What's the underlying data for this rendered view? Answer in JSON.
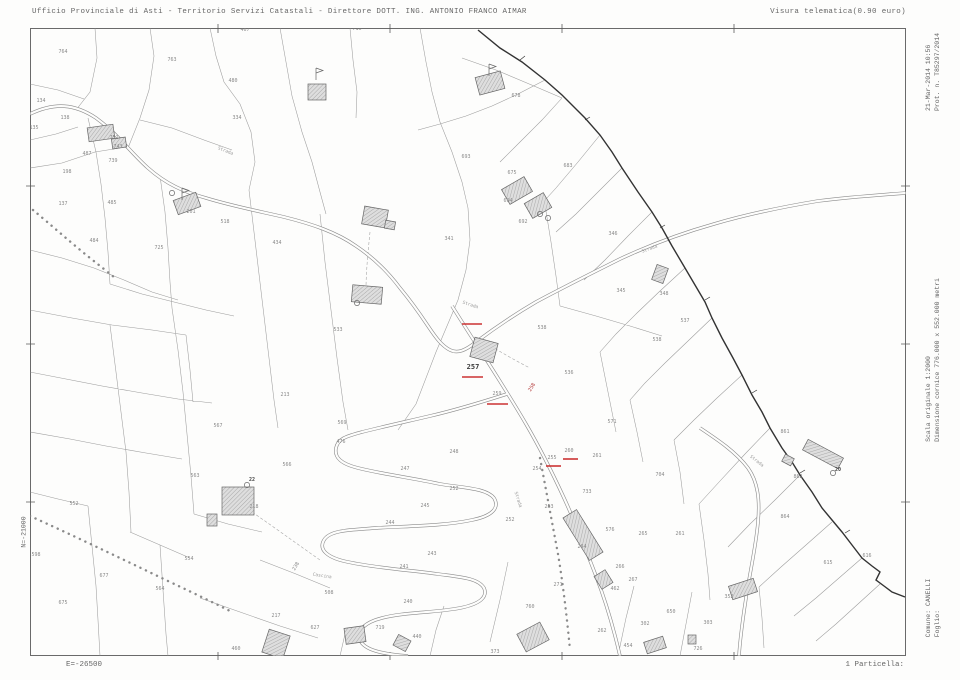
{
  "header": {
    "left": "Ufficio Provinciale di Asti - Territorio Servizi Catastali - Direttore DOTT. ING. ANTONIO FRANCO AIMAR",
    "right": "Visura telematica(0.90 euro)"
  },
  "margins": {
    "datetime": "21-Mar-2014 10:56",
    "protocol": "Prot. n. T85297/2014",
    "scale": "Scala originale 1:2000",
    "frame_size": "Dimensione cornice 776.000 x 552.000 metri",
    "comune": "Comune: CANELLI",
    "foglio": "Foglio:",
    "north_coord": "N=-21000",
    "east_coord": "E=-26500",
    "particella": "1 Particella:"
  },
  "colors": {
    "red": "#c33",
    "line": "#9c9c9c",
    "boundary": "#333333",
    "label": "#8a8a8a"
  },
  "map": {
    "selected_parcel": "257",
    "parcel_labels": [
      {
        "t": "716",
        "x": 357,
        "y": 30
      },
      {
        "t": "467",
        "x": 245,
        "y": 31
      },
      {
        "t": "764",
        "x": 63,
        "y": 53
      },
      {
        "t": "763",
        "x": 172,
        "y": 61
      },
      {
        "t": "480",
        "x": 233,
        "y": 82
      },
      {
        "t": "134",
        "x": 41,
        "y": 102
      },
      {
        "t": "138",
        "x": 65,
        "y": 119
      },
      {
        "t": "135",
        "x": 34,
        "y": 129
      },
      {
        "t": "487",
        "x": 87,
        "y": 155
      },
      {
        "t": "739",
        "x": 113,
        "y": 162
      },
      {
        "t": "198",
        "x": 67,
        "y": 173
      },
      {
        "t": "137",
        "x": 63,
        "y": 205
      },
      {
        "t": "485",
        "x": 112,
        "y": 204
      },
      {
        "t": "484",
        "x": 94,
        "y": 242
      },
      {
        "t": "725",
        "x": 159,
        "y": 249
      },
      {
        "t": "334",
        "x": 237,
        "y": 119
      },
      {
        "t": "201",
        "x": 191,
        "y": 213
      },
      {
        "t": "751",
        "x": 114,
        "y": 139
      },
      {
        "t": "743",
        "x": 118,
        "y": 148
      },
      {
        "t": "518",
        "x": 225,
        "y": 223
      },
      {
        "t": "434",
        "x": 277,
        "y": 244
      },
      {
        "t": "678",
        "x": 516,
        "y": 97
      },
      {
        "t": "693",
        "x": 466,
        "y": 158
      },
      {
        "t": "683",
        "x": 568,
        "y": 167
      },
      {
        "t": "675",
        "x": 512,
        "y": 174
      },
      {
        "t": "694",
        "x": 508,
        "y": 202
      },
      {
        "t": "692",
        "x": 523,
        "y": 223
      },
      {
        "t": "346",
        "x": 613,
        "y": 235
      },
      {
        "t": "341",
        "x": 449,
        "y": 240
      },
      {
        "t": "345",
        "x": 621,
        "y": 292
      },
      {
        "t": "348",
        "x": 664,
        "y": 295
      },
      {
        "t": "537",
        "x": 685,
        "y": 322
      },
      {
        "t": "538",
        "x": 657,
        "y": 341
      },
      {
        "t": "533",
        "x": 338,
        "y": 331
      },
      {
        "t": "213",
        "x": 285,
        "y": 396
      },
      {
        "t": "538",
        "x": 542,
        "y": 329
      },
      {
        "t": "536",
        "x": 569,
        "y": 374
      },
      {
        "t": "571",
        "x": 612,
        "y": 423
      },
      {
        "t": "261",
        "x": 597,
        "y": 457
      },
      {
        "t": "260",
        "x": 569,
        "y": 452
      },
      {
        "t": "255",
        "x": 552,
        "y": 459
      },
      {
        "t": "254",
        "x": 537,
        "y": 470
      },
      {
        "t": "733",
        "x": 587,
        "y": 493
      },
      {
        "t": "257",
        "x": 473,
        "y": 369,
        "sel": true
      },
      {
        "t": "259",
        "x": 497,
        "y": 395
      },
      {
        "t": "258",
        "x": 533,
        "y": 388,
        "r": -58,
        "red": true
      },
      {
        "t": "567",
        "x": 218,
        "y": 427
      },
      {
        "t": "569",
        "x": 342,
        "y": 424
      },
      {
        "t": "476",
        "x": 341,
        "y": 443
      },
      {
        "t": "563",
        "x": 195,
        "y": 477
      },
      {
        "t": "566",
        "x": 287,
        "y": 466
      },
      {
        "t": "218",
        "x": 254,
        "y": 508
      },
      {
        "t": "248",
        "x": 454,
        "y": 453
      },
      {
        "t": "247",
        "x": 405,
        "y": 470
      },
      {
        "t": "252",
        "x": 454,
        "y": 490
      },
      {
        "t": "245",
        "x": 425,
        "y": 507
      },
      {
        "t": "244",
        "x": 390,
        "y": 524
      },
      {
        "t": "243",
        "x": 432,
        "y": 555
      },
      {
        "t": "241",
        "x": 404,
        "y": 568
      },
      {
        "t": "240",
        "x": 408,
        "y": 603
      },
      {
        "t": "440",
        "x": 417,
        "y": 638
      },
      {
        "t": "460",
        "x": 236,
        "y": 650
      },
      {
        "t": "554",
        "x": 189,
        "y": 560
      },
      {
        "t": "217",
        "x": 276,
        "y": 617
      },
      {
        "t": "508",
        "x": 329,
        "y": 594
      },
      {
        "t": "627",
        "x": 315,
        "y": 629
      },
      {
        "t": "719",
        "x": 380,
        "y": 629
      },
      {
        "t": "238",
        "x": 297,
        "y": 567,
        "r": -60
      },
      {
        "t": "253",
        "x": 549,
        "y": 508
      },
      {
        "t": "252",
        "x": 510,
        "y": 521
      },
      {
        "t": "704",
        "x": 660,
        "y": 476
      },
      {
        "t": "576",
        "x": 610,
        "y": 531
      },
      {
        "t": "265",
        "x": 643,
        "y": 535
      },
      {
        "t": "261",
        "x": 680,
        "y": 535
      },
      {
        "t": "264",
        "x": 582,
        "y": 548
      },
      {
        "t": "266",
        "x": 620,
        "y": 568
      },
      {
        "t": "267",
        "x": 633,
        "y": 581
      },
      {
        "t": "271",
        "x": 558,
        "y": 586
      },
      {
        "t": "462",
        "x": 615,
        "y": 590
      },
      {
        "t": "760",
        "x": 530,
        "y": 608
      },
      {
        "t": "262",
        "x": 602,
        "y": 632
      },
      {
        "t": "302",
        "x": 645,
        "y": 625
      },
      {
        "t": "650",
        "x": 671,
        "y": 613
      },
      {
        "t": "303",
        "x": 708,
        "y": 624
      },
      {
        "t": "373",
        "x": 495,
        "y": 653
      },
      {
        "t": "454",
        "x": 628,
        "y": 647
      },
      {
        "t": "726",
        "x": 698,
        "y": 650
      },
      {
        "t": "352",
        "x": 729,
        "y": 598
      },
      {
        "t": "861",
        "x": 785,
        "y": 433
      },
      {
        "t": "862",
        "x": 798,
        "y": 478
      },
      {
        "t": "864",
        "x": 785,
        "y": 518
      },
      {
        "t": "615",
        "x": 828,
        "y": 564
      },
      {
        "t": "616",
        "x": 867,
        "y": 557
      },
      {
        "t": "20",
        "x": 838,
        "y": 471,
        "dark": true
      },
      {
        "t": "22",
        "x": 252,
        "y": 481,
        "dark": true
      },
      {
        "t": "552",
        "x": 74,
        "y": 505
      },
      {
        "t": "598",
        "x": 36,
        "y": 556
      },
      {
        "t": "677",
        "x": 104,
        "y": 577
      },
      {
        "t": "675",
        "x": 63,
        "y": 604
      },
      {
        "t": "564",
        "x": 160,
        "y": 590
      }
    ],
    "road_names": [
      {
        "t": "Strada",
        "x": 225,
        "y": 152,
        "r": 22
      },
      {
        "t": "Strada",
        "x": 470,
        "y": 306,
        "r": 18
      },
      {
        "t": "Strada",
        "x": 650,
        "y": 250,
        "r": -20
      },
      {
        "t": "Strada",
        "x": 517,
        "y": 500,
        "r": 72
      },
      {
        "t": "Cascina",
        "x": 322,
        "y": 577,
        "r": 8
      },
      {
        "t": "Strada",
        "x": 756,
        "y": 462,
        "r": 38
      }
    ],
    "red_marks": [
      [
        462,
        377,
        483,
        377
      ],
      [
        487,
        404,
        508,
        404
      ],
      [
        563,
        459,
        578,
        459
      ],
      [
        546,
        466,
        561,
        466
      ],
      [
        462,
        324,
        482,
        324
      ]
    ],
    "buildings": [
      [
        88,
        126,
        26,
        14,
        -8
      ],
      [
        112,
        138,
        14,
        10,
        -8
      ],
      [
        308,
        84,
        18,
        16,
        0
      ],
      [
        477,
        74,
        26,
        18,
        -15
      ],
      [
        175,
        196,
        24,
        15,
        -20
      ],
      [
        363,
        208,
        24,
        18,
        10
      ],
      [
        385,
        221,
        10,
        8,
        10
      ],
      [
        352,
        286,
        30,
        17,
        5
      ],
      [
        472,
        340,
        24,
        20,
        15
      ],
      [
        504,
        182,
        26,
        17,
        -30
      ],
      [
        527,
        197,
        22,
        17,
        -30
      ],
      [
        654,
        266,
        12,
        16,
        20
      ],
      [
        222,
        487,
        32,
        28,
        0
      ],
      [
        207,
        514,
        10,
        12,
        0
      ],
      [
        575,
        510,
        16,
        50,
        -32
      ],
      [
        597,
        572,
        13,
        15,
        -32
      ],
      [
        730,
        582,
        26,
        14,
        -18
      ],
      [
        803,
        448,
        40,
        12,
        28
      ],
      [
        783,
        456,
        10,
        8,
        28
      ],
      [
        520,
        627,
        26,
        20,
        -28
      ],
      [
        265,
        632,
        22,
        24,
        18
      ],
      [
        345,
        627,
        20,
        16,
        -8
      ],
      [
        395,
        637,
        14,
        12,
        28
      ],
      [
        645,
        639,
        20,
        12,
        -18
      ],
      [
        688,
        635,
        8,
        9,
        0
      ]
    ],
    "symbols": {
      "circles": [
        [
          172,
          193
        ],
        [
          540,
          214
        ],
        [
          548,
          218
        ],
        [
          247,
          485
        ],
        [
          833,
          473
        ],
        [
          357,
          303
        ]
      ],
      "flags": [
        [
          316,
          68
        ],
        [
          489,
          64
        ],
        [
          182,
          188
        ]
      ]
    }
  }
}
